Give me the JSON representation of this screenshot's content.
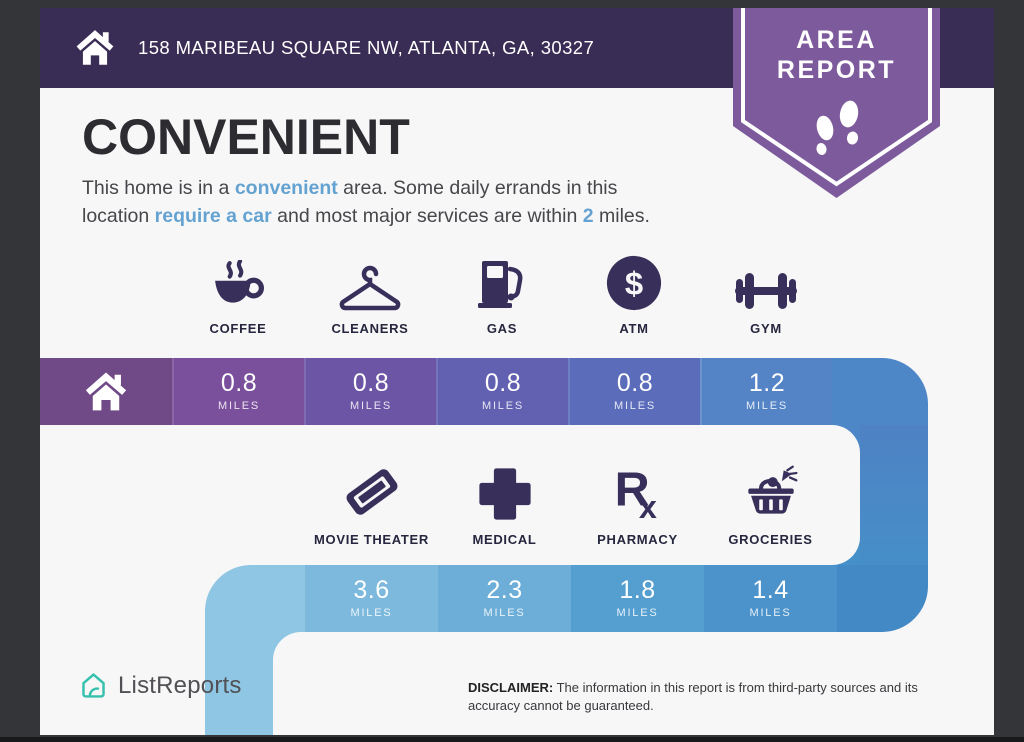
{
  "header": {
    "address": "158 MARIBEAU SQUARE NW, ATLANTA, GA, 30327"
  },
  "badge": {
    "line1": "AREA",
    "line2": "REPORT"
  },
  "main": {
    "title": "CONVENIENT",
    "description": {
      "line1": [
        {
          "text": "This home is in a "
        },
        {
          "text": "convenient",
          "highlight": true
        },
        {
          "text": " area. Some daily errands in this"
        }
      ],
      "line2": [
        {
          "text": "location "
        },
        {
          "text": "require a car",
          "highlight": true
        },
        {
          "text": " and most major services are within "
        },
        {
          "text": "2",
          "highlight": true
        },
        {
          "text": " miles."
        }
      ]
    }
  },
  "amenities_row1": [
    {
      "name": "COFFEE",
      "icon": "coffee-icon",
      "distance": "0.8",
      "unit": "MILES"
    },
    {
      "name": "CLEANERS",
      "icon": "hanger-icon",
      "distance": "0.8",
      "unit": "MILES"
    },
    {
      "name": "GAS",
      "icon": "gas-pump-icon",
      "distance": "0.8",
      "unit": "MILES"
    },
    {
      "name": "ATM",
      "icon": "dollar-circle-icon",
      "distance": "0.8",
      "unit": "MILES"
    },
    {
      "name": "GYM",
      "icon": "dumbbell-icon",
      "distance": "1.2",
      "unit": "MILES"
    }
  ],
  "amenities_row2": [
    {
      "name": "MOVIE THEATER",
      "icon": "movie-ticket-icon",
      "distance": "3.6",
      "unit": "MILES"
    },
    {
      "name": "MEDICAL",
      "icon": "medical-cross-icon",
      "distance": "2.3",
      "unit": "MILES"
    },
    {
      "name": "PHARMACY",
      "icon": "rx-icon",
      "distance": "1.8",
      "unit": "MILES"
    },
    {
      "name": "GROCERIES",
      "icon": "grocery-basket-icon",
      "distance": "1.4",
      "unit": "MILES"
    }
  ],
  "footer": {
    "brand": "ListReports",
    "disclaimer_label": "DISCLAIMER:",
    "disclaimer_text": " The information in this report is from third-party sources and its accuracy cannot be guaranteed."
  },
  "colors": {
    "frame": "#303032",
    "topbar": "#3a2d55",
    "badge_purple": "#7d5a9c",
    "content_bg": "#f7f7f8",
    "icon_navy": "#38305a",
    "highlight_blue": "#64a3d1",
    "brand_teal": "#35c1ae",
    "row1_segments": [
      "#6f4a86",
      "#7a4f9b",
      "#6d55a6",
      "#6160b1",
      "#5a6cba",
      "#5584c6",
      "#4d87c8"
    ],
    "vertical_strip_top": "#4f80c3",
    "vertical_strip_bottom": "#4590c9",
    "row2_segments": [
      "#8ec6e3",
      "#7cb9dc",
      "#6caed7",
      "#559fd0",
      "#4b93ca",
      "#4389c6"
    ],
    "left_strip": "#8ec6e3"
  }
}
